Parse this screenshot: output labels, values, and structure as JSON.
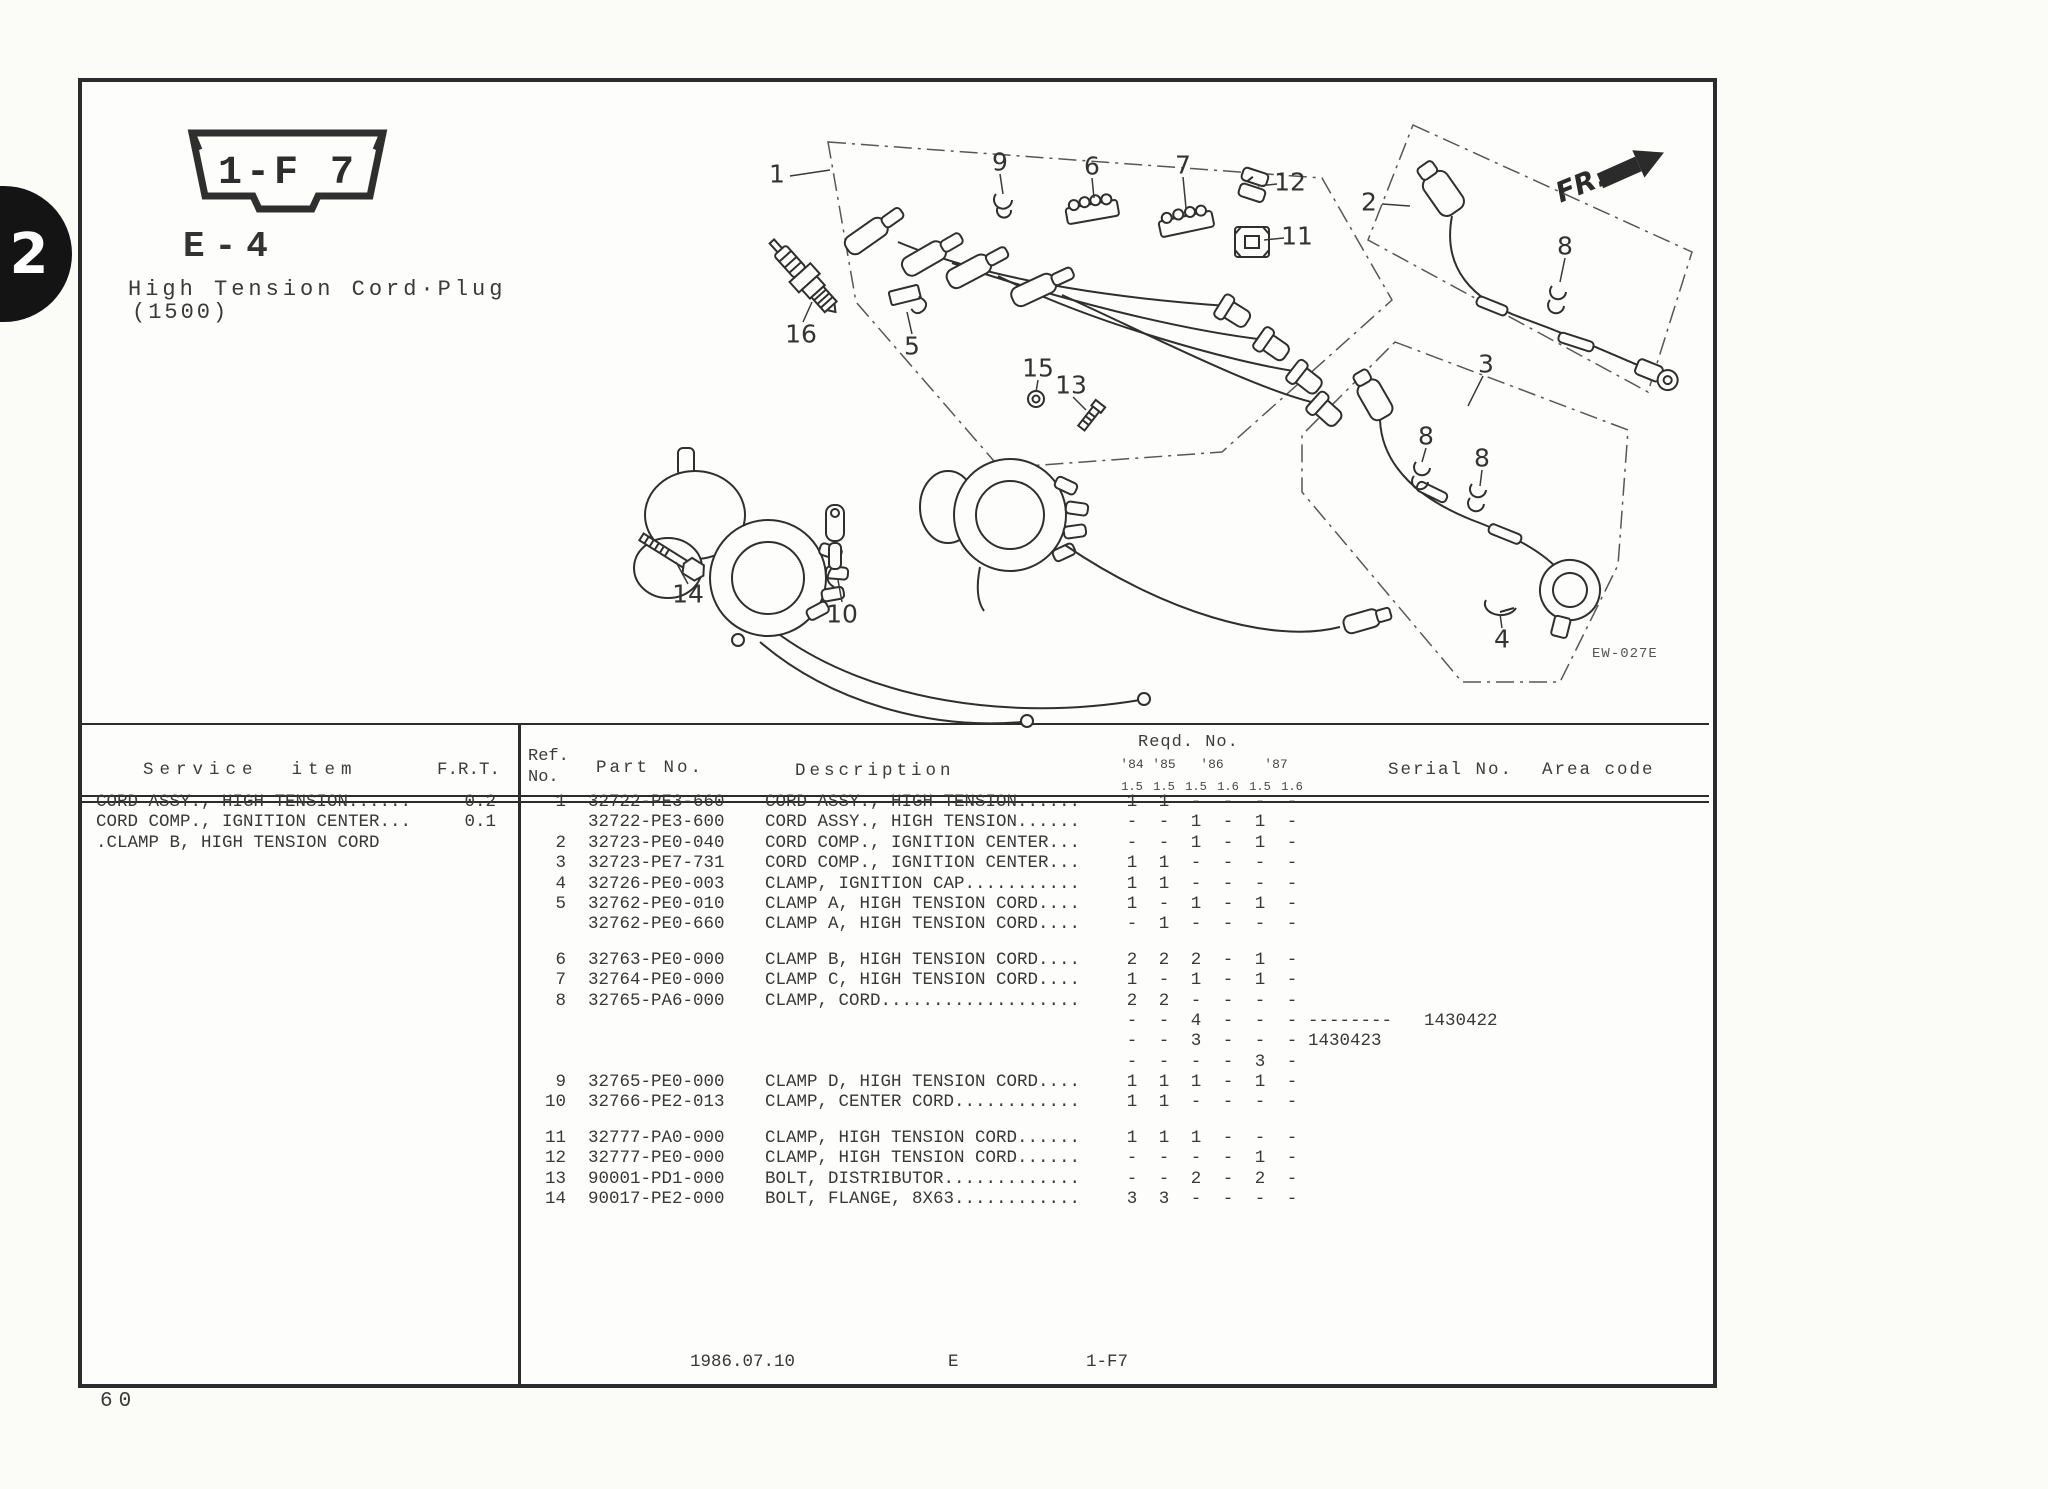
{
  "page": {
    "tab_number": "2",
    "badge": "1-F 7",
    "section_code": "E-4",
    "title_line1": "High Tension Cord·Plug",
    "title_line2": "(1500)",
    "fr_label": "FR.",
    "image_code": "EW-027E",
    "page_number": "60",
    "footer": {
      "date": "1986.07.10",
      "section": "E",
      "fiche": "1-F7"
    }
  },
  "service_panel": {
    "header_item": "Service  item",
    "header_frt": "F.R.T.",
    "rows": [
      {
        "item": "CORD ASSY., HIGH TENSION......",
        "frt": "0.2"
      },
      {
        "item": "CORD COMP., IGNITION CENTER...",
        "frt": "0.1"
      },
      {
        "item": ".CLAMP B, HIGH TENSION CORD",
        "frt": ""
      }
    ]
  },
  "parts_table": {
    "headers": {
      "ref": "Ref.",
      "no": "No.",
      "part": "Part No.",
      "desc": "Description",
      "reqd": "Reqd. No.",
      "years": [
        "'84",
        "'85",
        "'86",
        "'87"
      ],
      "trims": [
        "1.5",
        "1.5",
        "1.5",
        "1.6",
        "1.5",
        "1.6"
      ],
      "serial": "Serial No.",
      "area": "Area code"
    },
    "rows": [
      {
        "ref": "1",
        "part": "32722-PE3-660",
        "desc": "CORD ASSY., HIGH TENSION......",
        "q": [
          "1",
          "1",
          "-",
          "-",
          "-",
          "-"
        ],
        "s1": "",
        "s2": ""
      },
      {
        "ref": "",
        "part": "32722-PE3-600",
        "desc": "CORD ASSY., HIGH TENSION......",
        "q": [
          "-",
          "-",
          "1",
          "-",
          "1",
          "-"
        ],
        "s1": "",
        "s2": ""
      },
      {
        "ref": "2",
        "part": "32723-PE0-040",
        "desc": "CORD COMP., IGNITION CENTER...",
        "q": [
          "-",
          "-",
          "1",
          "-",
          "1",
          "-"
        ],
        "s1": "",
        "s2": ""
      },
      {
        "ref": "3",
        "part": "32723-PE7-731",
        "desc": "CORD COMP., IGNITION CENTER...",
        "q": [
          "1",
          "1",
          "-",
          "-",
          "-",
          "-"
        ],
        "s1": "",
        "s2": ""
      },
      {
        "ref": "4",
        "part": "32726-PE0-003",
        "desc": "CLAMP, IGNITION CAP...........",
        "q": [
          "1",
          "1",
          "-",
          "-",
          "-",
          "-"
        ],
        "s1": "",
        "s2": ""
      },
      {
        "ref": "5",
        "part": "32762-PE0-010",
        "desc": "CLAMP A, HIGH TENSION CORD....",
        "q": [
          "1",
          "-",
          "1",
          "-",
          "1",
          "-"
        ],
        "s1": "",
        "s2": ""
      },
      {
        "ref": "",
        "part": "32762-PE0-660",
        "desc": "CLAMP A, HIGH TENSION CORD....",
        "q": [
          "-",
          "1",
          "-",
          "-",
          "-",
          "-"
        ],
        "s1": "",
        "s2": ""
      },
      {
        "ref": "6",
        "part": "32763-PE0-000",
        "desc": "CLAMP B, HIGH TENSION CORD....",
        "q": [
          "2",
          "2",
          "2",
          "-",
          "1",
          "-"
        ],
        "s1": "",
        "s2": ""
      },
      {
        "ref": "7",
        "part": "32764-PE0-000",
        "desc": "CLAMP C, HIGH TENSION CORD....",
        "q": [
          "1",
          "-",
          "1",
          "-",
          "1",
          "-"
        ],
        "s1": "",
        "s2": ""
      },
      {
        "ref": "8",
        "part": "32765-PA6-000",
        "desc": "CLAMP, CORD...................",
        "q": [
          "2",
          "2",
          "-",
          "-",
          "-",
          "-"
        ],
        "s1": "",
        "s2": ""
      },
      {
        "ref": "",
        "part": "",
        "desc": "",
        "q": [
          "-",
          "-",
          "4",
          "-",
          "-",
          "-"
        ],
        "s1": "--------",
        "s2": "1430422"
      },
      {
        "ref": "",
        "part": "",
        "desc": "",
        "q": [
          "-",
          "-",
          "3",
          "-",
          "-",
          "-"
        ],
        "s1": "1430423",
        "s2": ""
      },
      {
        "ref": "",
        "part": "",
        "desc": "",
        "q": [
          "-",
          "-",
          "-",
          "-",
          "3",
          "-"
        ],
        "s1": "",
        "s2": ""
      },
      {
        "ref": "9",
        "part": "32765-PE0-000",
        "desc": "CLAMP D, HIGH TENSION CORD....",
        "q": [
          "1",
          "1",
          "1",
          "-",
          "1",
          "-"
        ],
        "s1": "",
        "s2": ""
      },
      {
        "ref": "10",
        "part": "32766-PE2-013",
        "desc": "CLAMP, CENTER CORD............",
        "q": [
          "1",
          "1",
          "-",
          "-",
          "-",
          "-"
        ],
        "s1": "",
        "s2": ""
      },
      {
        "ref": "11",
        "part": "32777-PA0-000",
        "desc": "CLAMP, HIGH TENSION CORD......",
        "q": [
          "1",
          "1",
          "1",
          "-",
          "-",
          "-"
        ],
        "s1": "",
        "s2": ""
      },
      {
        "ref": "12",
        "part": "32777-PE0-000",
        "desc": "CLAMP, HIGH TENSION CORD......",
        "q": [
          "-",
          "-",
          "-",
          "-",
          "1",
          "-"
        ],
        "s1": "",
        "s2": ""
      },
      {
        "ref": "13",
        "part": "90001-PD1-000",
        "desc": "BOLT, DISTRIBUTOR.............",
        "q": [
          "-",
          "-",
          "2",
          "-",
          "2",
          "-"
        ],
        "s1": "",
        "s2": ""
      },
      {
        "ref": "14",
        "part": "90017-PE2-000",
        "desc": "BOLT, FLANGE, 8X63............",
        "q": [
          "3",
          "3",
          "-",
          "-",
          "-",
          "-"
        ],
        "s1": "",
        "s2": ""
      }
    ]
  },
  "diagram": {
    "callouts": [
      "1",
      "9",
      "6",
      "7",
      "12",
      "11",
      "2",
      "8",
      "16",
      "5",
      "15",
      "13",
      "3",
      "8",
      "8",
      "14",
      "10",
      "4"
    ]
  }
}
